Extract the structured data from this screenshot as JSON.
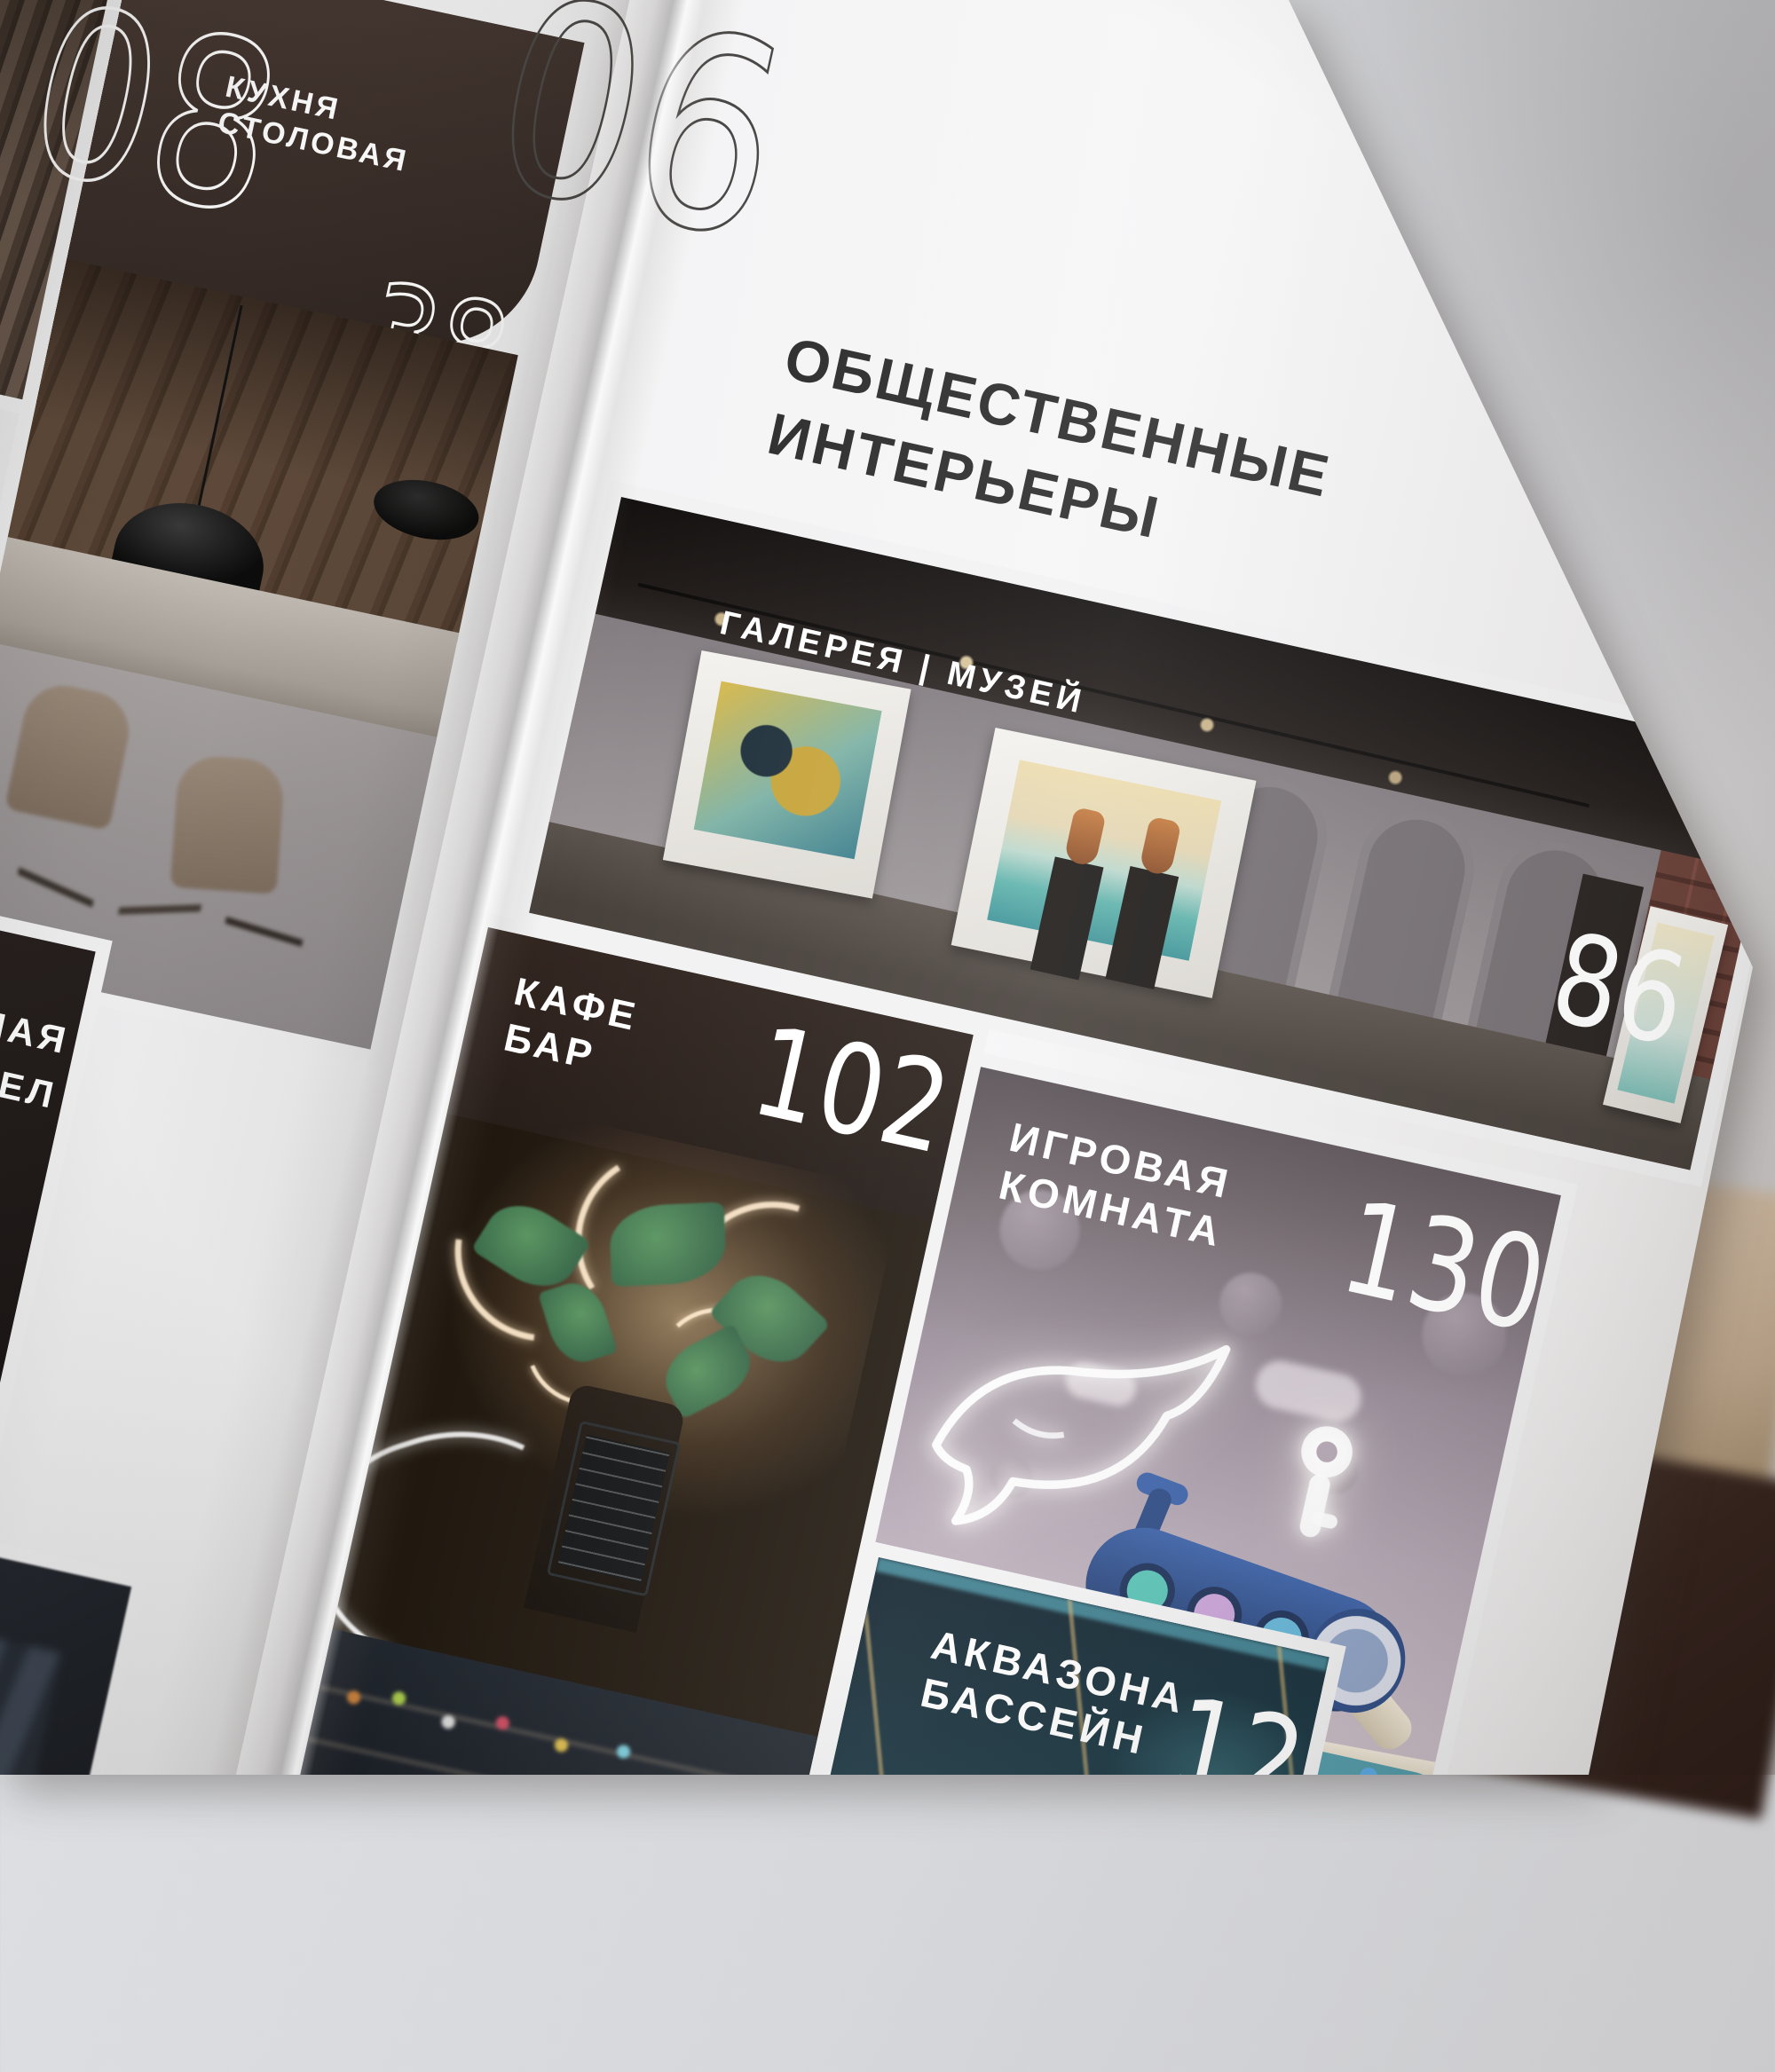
{
  "left_page": {
    "top_page_number": "08",
    "section_number": "06",
    "kitchen_tile": {
      "label_line1": "КУХНЯ",
      "label_line2": "СТОЛОВАЯ",
      "page_number": "38"
    },
    "bath_tile": {
      "label_fragment1": "НАЯ",
      "label_fragment2": "ЗЕЛ"
    }
  },
  "right_page": {
    "heading_line1": "ОБЩЕСТВЕННЫЕ",
    "heading_line2": "ИНТЕРЬЕРЫ",
    "gallery_tile": {
      "label": "ГАЛЕРЕЯ | МУЗЕЙ",
      "page_number": "86"
    },
    "cafe_tile": {
      "label_line1": "КАФЕ",
      "label_line2": "БАР",
      "page_number": "102"
    },
    "playroom_tile": {
      "label_line1": "ИГРОВАЯ",
      "label_line2": "КОМНАТА",
      "page_number": "130"
    },
    "aqua_tile": {
      "label_line1": "АКВАЗОНА",
      "label_line2": "БАССЕЙН",
      "page_number_partial": "12"
    }
  },
  "colors": {
    "page": "#f3f3f4",
    "ink": "#2e2d2e",
    "label_white": "#ffffff",
    "kitchen_header": "#3a2f2c",
    "cafe_header": "#2b211d",
    "background_wall": "#d5d7db",
    "background_wood": "#ad8457",
    "background_floor": "#35231d"
  }
}
